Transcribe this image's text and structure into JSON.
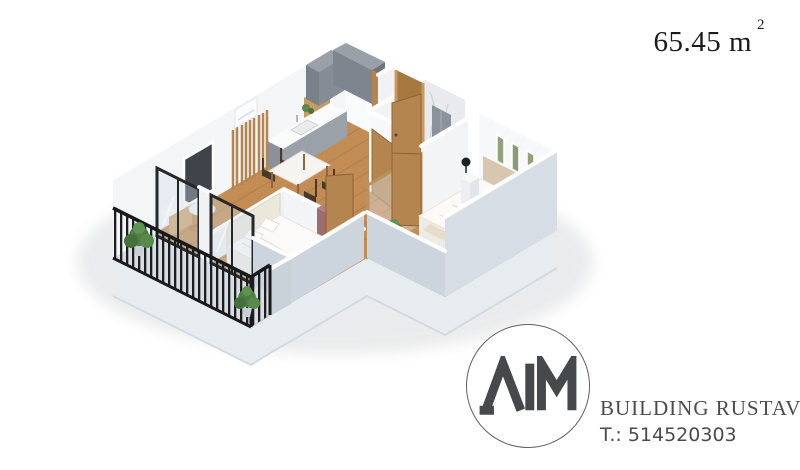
{
  "area_label": {
    "value": "65.45",
    "unit": "m",
    "superscript": "2"
  },
  "logo": {
    "monogram": "AIM",
    "company": "BUILDING RUSTAVI",
    "phone": "T.: 514520303"
  },
  "floor_plan": {
    "description": "3D isometric render of a one-bedroom-plus apartment",
    "rooms": [
      "living-kitchen",
      "hallway",
      "bathroom",
      "bedroom-1",
      "bedroom-2",
      "balcony"
    ],
    "furniture": [
      "kitchen-upper-cabinets",
      "counter-with-sink",
      "dining-table",
      "dining-chairs",
      "wood-slat-partition",
      "air-conditioner",
      "wall-niche",
      "console",
      "round-table",
      "double-bed",
      "headboard",
      "nightstands",
      "black-lamps",
      "wall-frames",
      "mauve-dresser",
      "shower-panel",
      "glass-balcony-doors",
      "wooden-doors",
      "balcony-railing",
      "plants"
    ]
  },
  "colors": {
    "background": "#ffffff",
    "wall_white": "#f5f6f8",
    "wall_exterior": "#ccd4dd",
    "floor_wood": "#c28c54",
    "floor_bath": "#d6d9dd",
    "balcony_floor": "#d9dde1",
    "railing_black": "#1c1f22",
    "door_wood": "#b5854f",
    "cabinet_gray": "#7f858e",
    "dresser_mauve": "#9e6b70",
    "plant_green": "#4e7d46",
    "bed_white": "#fbfaf8",
    "logo_gray": "#46494c",
    "text_dark": "#1b1b1b"
  }
}
